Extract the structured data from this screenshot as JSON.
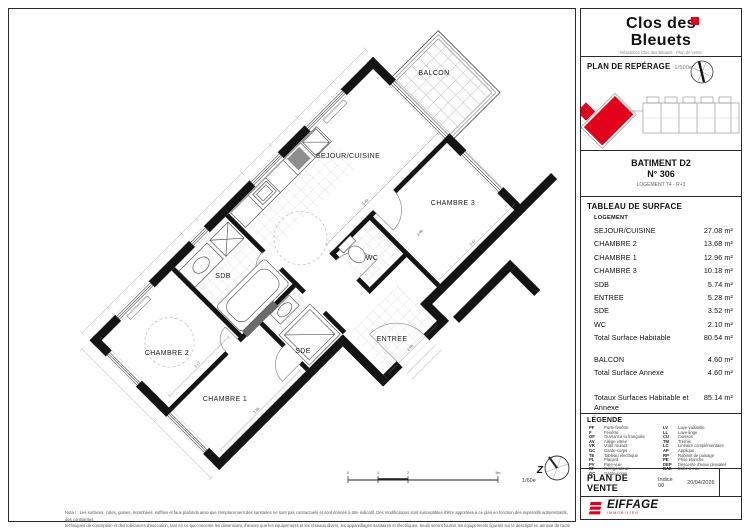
{
  "colors": {
    "accent": "#e2001a",
    "wall": "#141414"
  },
  "header": {
    "title1": "Clos des",
    "title2": "Bleuets",
    "address": "Résidence Clos des Bleuets · Plan de vente"
  },
  "reperage": {
    "title": "PLAN DE REPÉRAGE",
    "scale": "1/500e"
  },
  "batiment": {
    "name": "BATIMENT D2",
    "numero": "N° 306",
    "logement": "LOGEMENT T4 - R+3"
  },
  "surfaces": {
    "title": "TABLEAU DE SURFACE",
    "group_label": "LOGEMENT",
    "rows": [
      {
        "label": "SEJOUR/CUISINE",
        "value": "27.08 m²"
      },
      {
        "label": "CHAMBRE 2",
        "value": "13.68 m²"
      },
      {
        "label": "CHAMBRE 1",
        "value": "12.96 m²"
      },
      {
        "label": "CHAMBRE 3",
        "value": "10.18 m²"
      },
      {
        "label": "SDB",
        "value": "5.74 m²"
      },
      {
        "label": "ENTREE",
        "value": "5.28 m²"
      },
      {
        "label": "SDE",
        "value": "3.52 m²"
      },
      {
        "label": "WC",
        "value": "2.10 m²"
      }
    ],
    "total_habitable": {
      "label": "Total Surface Habitable",
      "value": "80.54 m²"
    },
    "balcon": {
      "label": "BALCON",
      "value": "4.60 m²"
    },
    "total_annexe": {
      "label": "Total Surface Annexe",
      "value": "4.60 m²"
    },
    "total_global": {
      "label": "Totaux Surfaces Habitable et Annexe",
      "value": "85.14 m²"
    }
  },
  "legende": {
    "title": "LÉGENDE",
    "col1": [
      {
        "abbr": "PF",
        "label": "Porte-fenêtre"
      },
      {
        "abbr": "F",
        "label": "Fenêtre"
      },
      {
        "abbr": "OF",
        "label": "Ouvrant à la française"
      },
      {
        "abbr": "AV",
        "label": "Allège vitrée"
      },
      {
        "abbr": "VR",
        "label": "Volet roulant"
      },
      {
        "abbr": "GC",
        "label": "Garde-corps"
      },
      {
        "abbr": "TE",
        "label": "Tableau électrique"
      },
      {
        "abbr": "PL",
        "label": "Placard"
      },
      {
        "abbr": "PV",
        "label": "Pare-vue"
      },
      {
        "abbr": "RF",
        "label": "Réfrigérateur"
      },
      {
        "abbr": "GC",
        "label": "Garde-corps"
      }
    ],
    "col2": [
      {
        "abbr": "LV",
        "label": "Lave-vaisselle"
      },
      {
        "abbr": "LL",
        "label": "Lave-linge"
      },
      {
        "abbr": "CU",
        "label": "Cuisson"
      },
      {
        "abbr": "TM",
        "label": "Trémie"
      },
      {
        "abbr": "LC",
        "label": "Linéaire complémentaire"
      },
      {
        "abbr": "AP",
        "label": "Applique"
      },
      {
        "abbr": "RP",
        "label": "Robinet de puisage"
      },
      {
        "abbr": "PE",
        "label": "Prise étanche"
      },
      {
        "abbr": "DEP",
        "label": "Descente d'eaux pluviales"
      },
      {
        "abbr": "BAE",
        "label": "Boîte à eau"
      }
    ]
  },
  "vente": {
    "title": "PLAN DE VENTE",
    "indice": "Indice 00",
    "date": "20/04/2026"
  },
  "logo": {
    "name": "EIFFAGE",
    "sub": "IMMOBILIER"
  },
  "plan": {
    "rooms": [
      {
        "label": "BALCON"
      },
      {
        "label": "SEJOUR/CUISINE"
      },
      {
        "label": "CHAMBRE 3"
      },
      {
        "label": "SDB"
      },
      {
        "label": "WC"
      },
      {
        "label": "CHAMBRE 2"
      },
      {
        "label": "SDE"
      },
      {
        "label": "ENTREE"
      },
      {
        "label": "CHAMBRE 1"
      }
    ],
    "dims": [
      "3.17",
      "3.85",
      "5.40",
      "3.47",
      "2.95",
      "3.98"
    ],
    "scale_label": "1/60e",
    "north_letter": "Z",
    "scale_ticks": [
      "0",
      "1",
      "2",
      "5m"
    ],
    "notes": [
      "Nota ! : Les surfaces, cotes, gaines, retombées, soffites et faux plafonds ainsi que l'emplacement des sanitaires ne sont pas contractuels et sont donnés à titre indicatif. Des modifications sont susceptibles d'être apportées à ce plan en fonction des impératifs administratifs, des contraintes",
      "techniques de conception et des tolérances d'exécution, tant en ce qui concerne les dimensions d'œuvre que les équipements et les réseaux divers, les appareillages sanitaires et électriques. Seuls seront fournis les équipements figurant sur le descriptif en annexe de l'acte de vente."
    ]
  }
}
